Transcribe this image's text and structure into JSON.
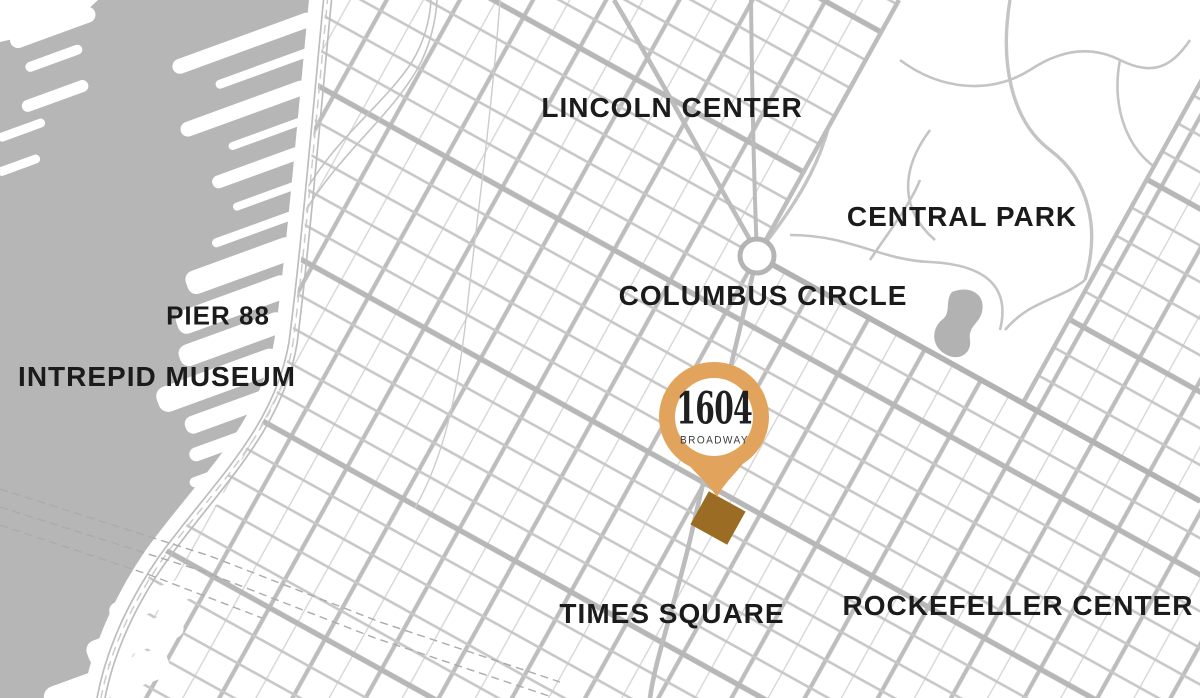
{
  "map": {
    "labels": [
      {
        "id": "lincoln-center",
        "text": "LINCOLN CENTER"
      },
      {
        "id": "central-park",
        "text": "CENTRAL PARK"
      },
      {
        "id": "columbus-circle",
        "text": "COLUMBUS CIRCLE"
      },
      {
        "id": "pier-88",
        "text": "PIER 88"
      },
      {
        "id": "intrepid-museum",
        "text": "INTREPID MUSEUM"
      },
      {
        "id": "times-square",
        "text": "TIMES SQUARE"
      },
      {
        "id": "rockefeller-center",
        "text": "ROCKEFELLER CENTER"
      }
    ],
    "marker": {
      "number": "1604",
      "street": "BROADWAY"
    },
    "colors": {
      "water": "#b6b6b6",
      "street": "#c7c7c7",
      "avenue": "#bdbdbd",
      "major_street": "#b7b7b7",
      "pin_ring": "#e2a45c",
      "building_footprint": "#9a6c24",
      "label_text": "#1b1b1b"
    }
  }
}
